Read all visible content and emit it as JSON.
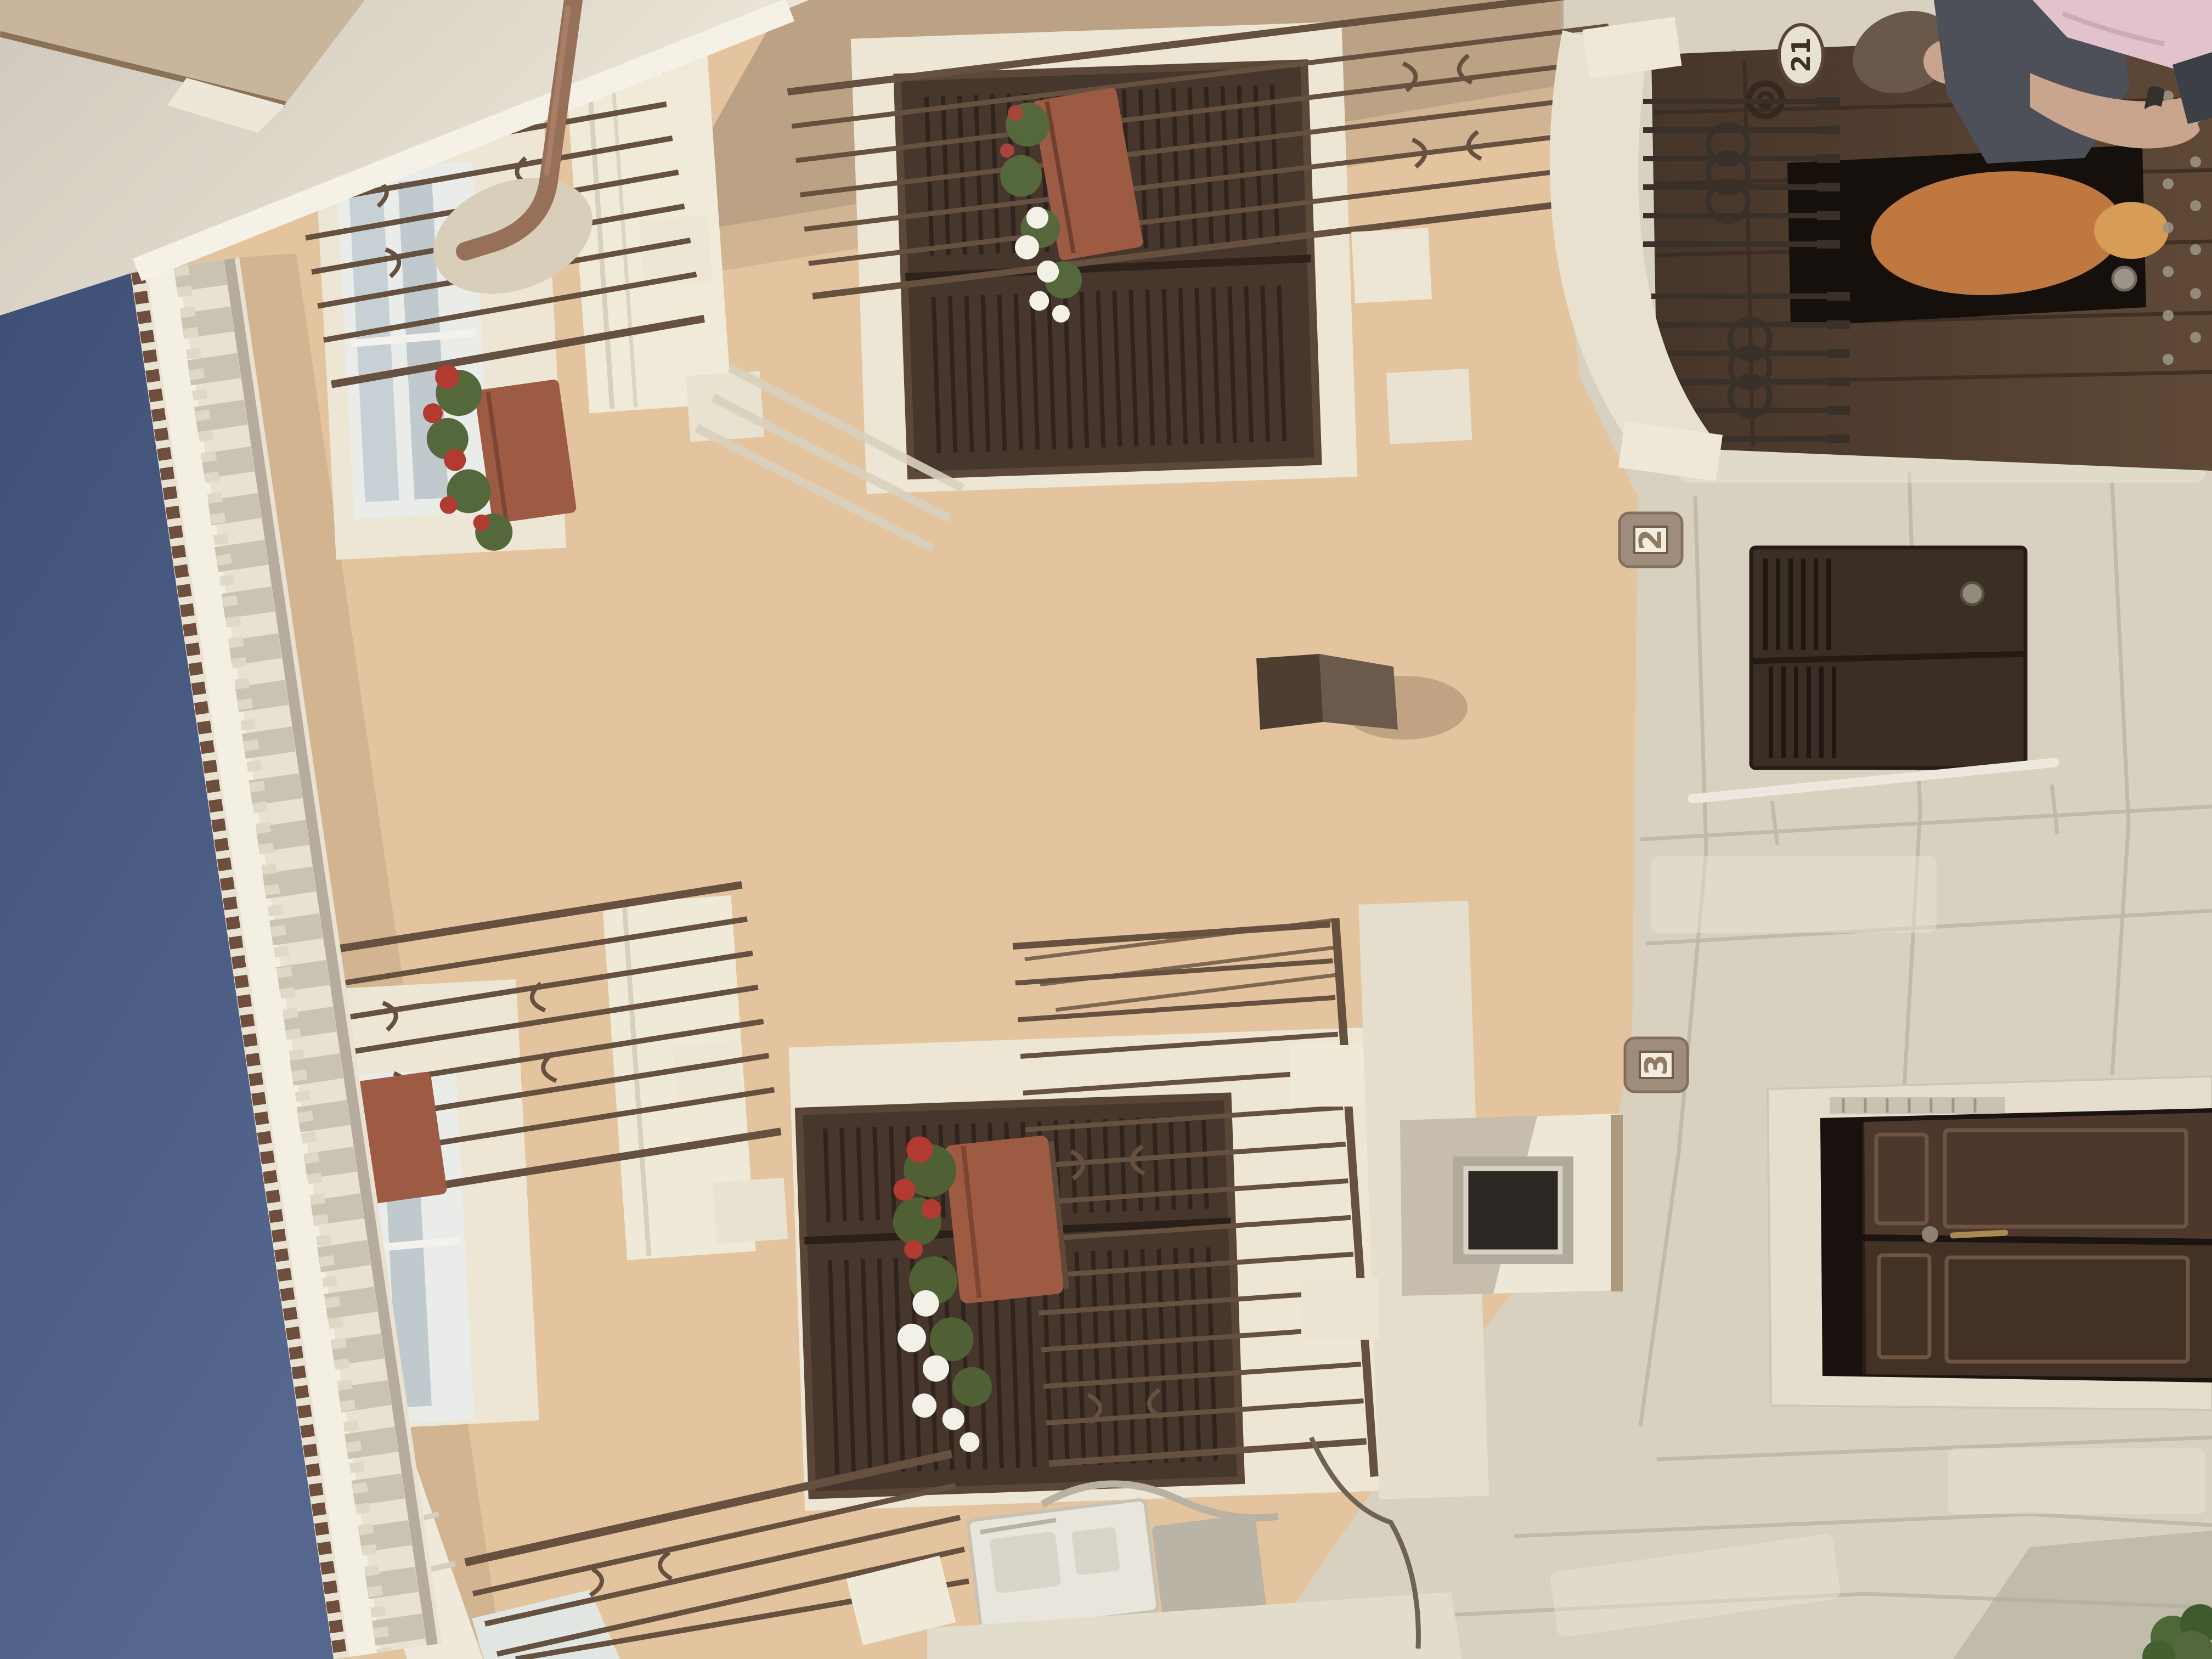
{
  "scene": {
    "type": "photograph",
    "subject": "Sunlit Mediterranean residential facade with wrought-iron balconies, brown louvered shutters, flower boxes, an arched wooden portal with people in the doorway, and a rusticated stone ground floor",
    "orientation": "image rotated 90 degrees counterclockwise: sky along left edge, street level along right edge"
  },
  "plaques": [
    {
      "value": "2"
    },
    {
      "value": "3"
    }
  ],
  "portal": {
    "plate_number": "21"
  },
  "colors": {
    "sky": "#42547A",
    "sky_light": "#53658C",
    "facade": "#E3C49E",
    "facade_shaded": "#A5947F",
    "stone_trim": "#EDE6D5",
    "stone_masonry": "#D8D1C0",
    "shutter_brown": "#47362C",
    "portal_door_brown": "#57422F",
    "entry_door_brown": "#4C382C",
    "cellar_door_brown": "#3A2E25",
    "railing_iron": "#66503F",
    "terracotta": "#9D5B44",
    "copper_pipe": "#97705A",
    "flower_red": "#B23B31",
    "flower_white": "#F3F0E8",
    "foliage_green": "#55683B"
  }
}
